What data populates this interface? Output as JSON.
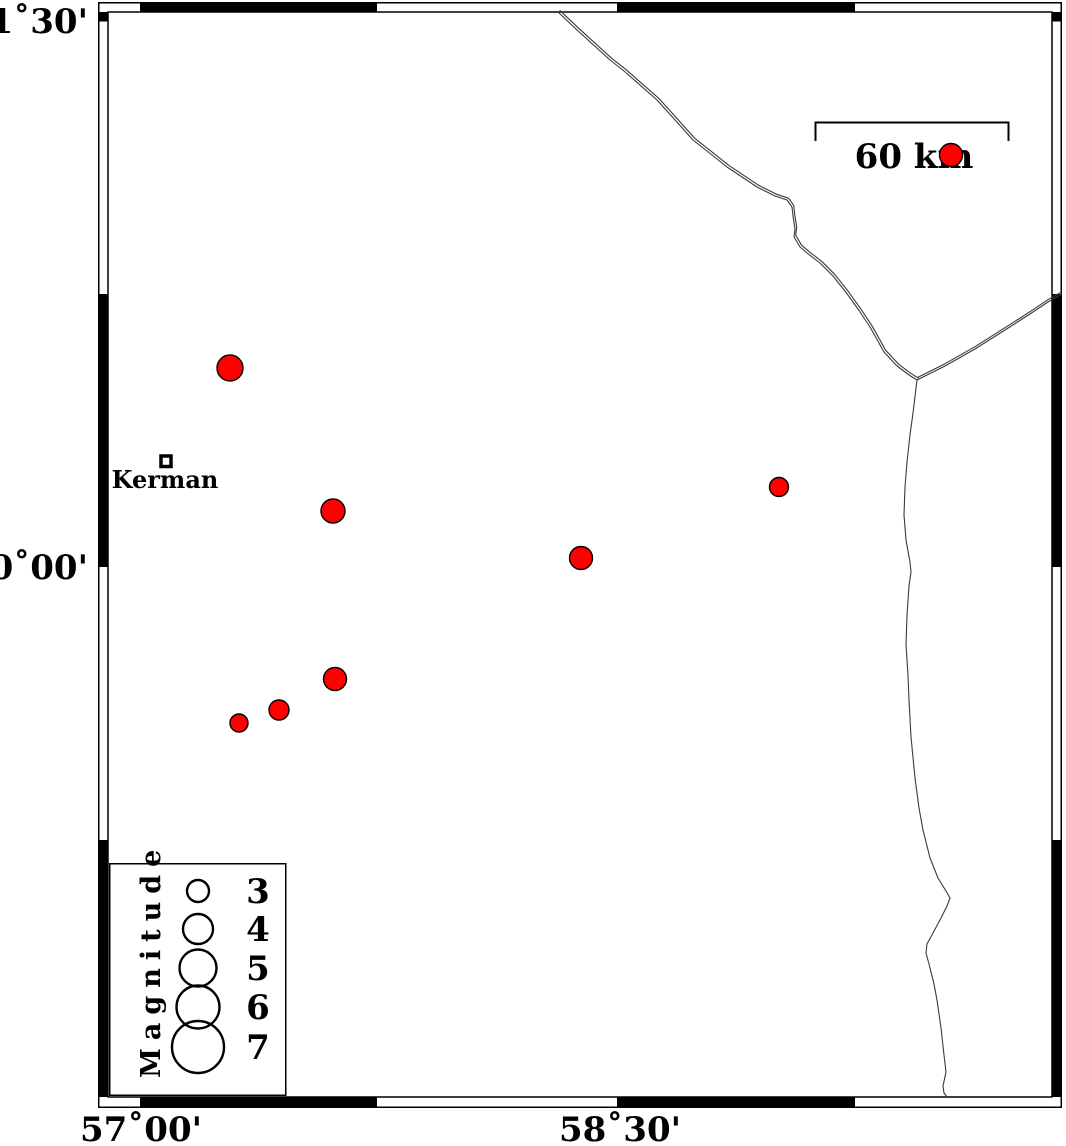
{
  "axes": {
    "lat_labels": [
      {
        "text": "31˚30'",
        "y": 21
      },
      {
        "text": "30˚00'",
        "y": 567
      }
    ],
    "lon_labels": [
      {
        "text": "57˚00'",
        "x": 141
      },
      {
        "text": "58˚30'",
        "x": 620
      }
    ]
  },
  "scale_bar": {
    "label": "60 km"
  },
  "city": {
    "label": "Kerman",
    "x": 166,
    "y": 461
  },
  "legend": {
    "title": "Magnitude",
    "circle_cx": 198,
    "label_x": 258,
    "entries": [
      {
        "label": "3",
        "cy": 891,
        "radius_px": 11
      },
      {
        "label": "4",
        "cy": 929,
        "radius_px": 15
      },
      {
        "label": "5",
        "cy": 968,
        "radius_px": 18.5
      },
      {
        "label": "6",
        "cy": 1007,
        "radius_px": 21.5
      },
      {
        "label": "7",
        "cy": 1047,
        "radius_px": 26
      }
    ]
  },
  "earthquakes": [
    {
      "x": 230,
      "y": 368,
      "radius_px": 13,
      "magnitude_approx": 3.5,
      "lon_approx": 57.28,
      "lat_approx": 30.55
    },
    {
      "x": 951,
      "y": 155,
      "radius_px": 11.5,
      "magnitude_approx": 3.1,
      "lon_approx": 59.53,
      "lat_approx": 31.13
    },
    {
      "x": 333,
      "y": 511,
      "radius_px": 12,
      "magnitude_approx": 3.3,
      "lon_approx": 57.6,
      "lat_approx": 30.15
    },
    {
      "x": 581,
      "y": 558,
      "radius_px": 11.5,
      "magnitude_approx": 3.1,
      "lon_approx": 58.38,
      "lat_approx": 30.02
    },
    {
      "x": 779,
      "y": 487,
      "radius_px": 9.5,
      "magnitude_approx": 2.8,
      "lon_approx": 59.0,
      "lat_approx": 30.22
    },
    {
      "x": 335,
      "y": 679,
      "radius_px": 11.5,
      "magnitude_approx": 3.1,
      "lon_approx": 57.61,
      "lat_approx": 29.69
    },
    {
      "x": 279,
      "y": 710,
      "radius_px": 10,
      "magnitude_approx": 2.9,
      "lon_approx": 57.43,
      "lat_approx": 29.61
    },
    {
      "x": 239,
      "y": 723,
      "radius_px": 9,
      "magnitude_approx": 2.7,
      "lon_approx": 57.31,
      "lat_approx": 29.57
    }
  ],
  "borders": {
    "north": "558,12 577,30 610,60 624,71 657,100 676,121 693,140 712,155 727,167 745,179 757,187 775,196 787,200 792,207 793,216 795,229 794,237 800,247 807,253 820,263 833,276 845,291 858,309 870,327 884,352 897,366 909,375 917,380",
    "east": "917,380 945,366 975,349 1005,330 1030,314 1048,302 1062,294",
    "south": "917,380 913,413 910,435 907,462 905,487 904,515 906,540 910,562 911,572 909,586 907,615 906,645 908,675 909,700 911,737 915,778 919,808 923,830 930,858 938,878 946,891 950,898 947,906 941,918 933,933 927,944 926,953 929,964 934,984 937,1000 941,1028 944,1055 946,1072 943,1086 944,1093 947,1097"
  },
  "colors": {
    "epicenter": "#ff0000",
    "outline": "#000000",
    "background": "#ffffff"
  }
}
